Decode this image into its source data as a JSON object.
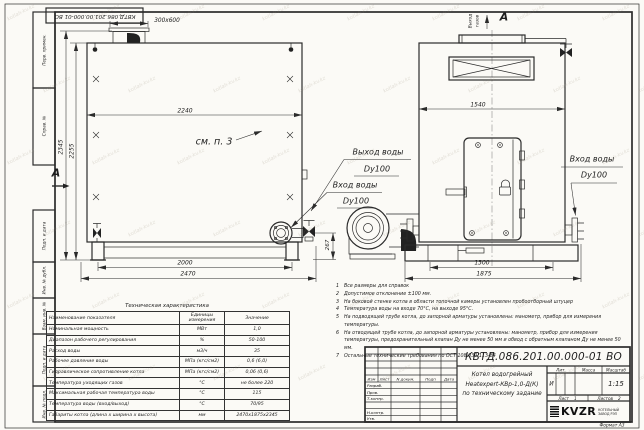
{
  "watermark": "kotlah-kv.kz",
  "stamp_top": "КВТД.086.201.00.000-01 ВО",
  "frame_left": {
    "cells": [
      "Перв. примен.",
      "Справ. №",
      "Подп. и дата",
      "Инв. № дубл.",
      "Взам. инв. №",
      "Подп. и дата",
      "Инв. № подл."
    ]
  },
  "dims": {
    "chimney": "300х600",
    "front_width": "2240",
    "height_full": "2345",
    "height_body": "2255",
    "front_base": "2000",
    "front_overall": "2470",
    "fan_offset": "267",
    "side_width": "1540",
    "side_base": "1300",
    "side_overall": "1875"
  },
  "callouts": {
    "see_ref": "см. п. 3",
    "section_label": "А",
    "view_label": "А",
    "gas_out_1": "Выход",
    "gas_out_2": "газов",
    "water_out": {
      "t": "Выход воды",
      "d": "Dy100"
    },
    "water_in_left": {
      "t": "Вход воды",
      "d": "Dy100"
    },
    "water_in_right": {
      "t": "Вход воды",
      "d": "Dy100"
    }
  },
  "notes": [
    {
      "n": "1",
      "t": "Все размеры для справок"
    },
    {
      "n": "2",
      "t": "Допустимое отклонение ±100 мм."
    },
    {
      "n": "3",
      "t": "На боковой стенке котла в области топочной камеры установлен пробоотборный штуцер"
    },
    {
      "n": "4",
      "t": "Температура воды на входе 70°С, на выходе 95°С."
    },
    {
      "n": "5",
      "t": "На подводящей трубе котла, до запорной арматуры установлены: манометр, прибор для измерения температуры."
    },
    {
      "n": "6",
      "t": "На отводящей трубе котла, до запорной арматуры установлены: манометр, прибор для измерения температуры, предохранительный клапан Ду не менее 50 мм и обвод с обратным клапаном Ду не менее 50 мм."
    },
    {
      "n": "7",
      "t": "Остальные технические требования по ОСТ 108.030.113-84"
    }
  ],
  "tech_table": {
    "title": "Техническая характеристика",
    "headers": [
      "Наименование показателя",
      "Единицы измерения",
      "Значение"
    ],
    "rows": [
      [
        "Номинальная мощность",
        "МВт",
        "1,0"
      ],
      [
        "Диапазон рабочего регулирования",
        "%",
        "50-100"
      ],
      [
        "Расход воды",
        "м3/ч",
        "35"
      ],
      [
        "Рабочее давление воды",
        "МПа (кгс/см2)",
        "0,6 (6,0)"
      ],
      [
        "Гидравлическое сопротивление котла",
        "МПа (кгс/см2)",
        "0,06 (0,6)"
      ],
      [
        "Температура уходящих газов",
        "°С",
        "не более 220"
      ],
      [
        "Максимальная рабочая температура воды",
        "°С",
        "115"
      ],
      [
        "Температура воды (вход/выход)",
        "°С",
        "70/95"
      ],
      [
        "Габариты котла (длина х ширина х высота)",
        "мм",
        "2470х1875х2345"
      ]
    ]
  },
  "title_block": {
    "doc_number": "КВТД.086.201.00.000-01 ВО",
    "name_line1": "Котел водогрейный",
    "name_line2": "Heatexpert-КВр-1,0-Д(К)",
    "name_line3": "по техническому задание",
    "header_cols": [
      "Изм",
      "Лист",
      "N докум.",
      "Подп",
      "Дата"
    ],
    "roles": [
      "Разраб.",
      "Пров.",
      "Т.контр.",
      "Н.контр.",
      "Утв."
    ],
    "lit_label": "Лит.",
    "mass_label": "Масса",
    "scale_label": "Масштаб",
    "lit_value": "И",
    "scale_value": "1:15",
    "sheet_label": "Лист",
    "sheet_value": "1",
    "sheets_label": "Листов",
    "sheets_value": "2",
    "logo_text": "KVZR",
    "logo_sub1": "КОТЕЛЬНЫЙ",
    "logo_sub2": "ЗАВОД РЭП",
    "format_note": "Формат А3"
  }
}
